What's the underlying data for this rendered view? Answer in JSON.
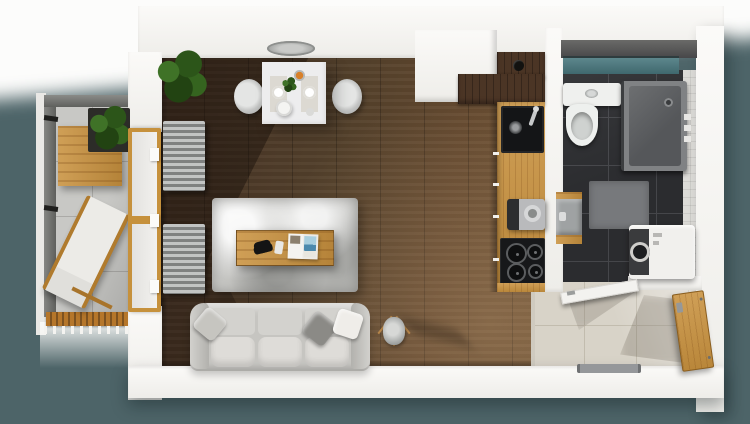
{
  "scene": {
    "type": "3d-floorplan-top-view",
    "description": "Top-down 3D render of a studio apartment with balcony, living room, kitchen line, bathroom and entry hallway",
    "background_color": "#4d6468",
    "wall_color": "#f5f4f1"
  },
  "rooms": [
    {
      "id": "balcony",
      "name": "Balcony",
      "floor": "concrete tiles",
      "floor_color": "#c8c8c5",
      "items": [
        "wood table",
        "potted plant",
        "sun lounger with cushion",
        "wood slat railing",
        "concrete parapet"
      ]
    },
    {
      "id": "living-room",
      "name": "Living room",
      "floor": "walnut plank floor",
      "floor_color": "#54402b",
      "items": [
        "white dining table",
        "two shell chairs",
        "placemats and plates",
        "centerpiece plant",
        "fruit bowl",
        "ceiling lamp on wall top",
        "potted fern",
        "balcony glass door with oak frame",
        "two radiators",
        "shag area rug",
        "oak coffee table",
        "game controller",
        "remote control",
        "open magazine",
        "three-seat gray sofa",
        "three throw pillows",
        "tripod floor lamp"
      ]
    },
    {
      "id": "kitchen",
      "name": "Kitchen line",
      "floor": "oak countertop run",
      "floor_color": "#c9923f",
      "items": [
        "dark walnut upper counter",
        "black jar",
        "black sink with faucet",
        "oak countertop",
        "coffee machine",
        "black cooktop with four burners"
      ]
    },
    {
      "id": "bathroom",
      "name": "Bathroom",
      "floor": "dark tiles",
      "floor_color": "#2b2c2f",
      "items": [
        "teal glass window",
        "toilet with cistern",
        "gray shower enclosure",
        "wall basin with oak trim",
        "gray bath mat",
        "washing machine",
        "white swing door"
      ]
    },
    {
      "id": "hallway",
      "name": "Entry hallway",
      "floor": "beige tiles",
      "floor_color": "#d8d3c8",
      "items": [
        "oak entry door",
        "gray doormat",
        "floor transition strip"
      ]
    }
  ],
  "palette": {
    "background_teal": "#4d6468",
    "wall_white": "#f5f4f1",
    "wood_oak": "#c9923f",
    "wood_walnut": "#4b3525",
    "wood_floor": "#54402b",
    "tile_dark": "#2b2c2f",
    "tile_beige": "#d8d3c8",
    "tile_concrete": "#c8c8c5",
    "window_glass_teal": "#4f7b81",
    "sofa_gray": "#c6c5c1",
    "rug_gray": "#cfcfcc",
    "appliance_white": "#f1f0ed",
    "appliance_black": "#17181a",
    "radiator_gray": "#9fa19f",
    "plant_green": "#2c5519"
  }
}
